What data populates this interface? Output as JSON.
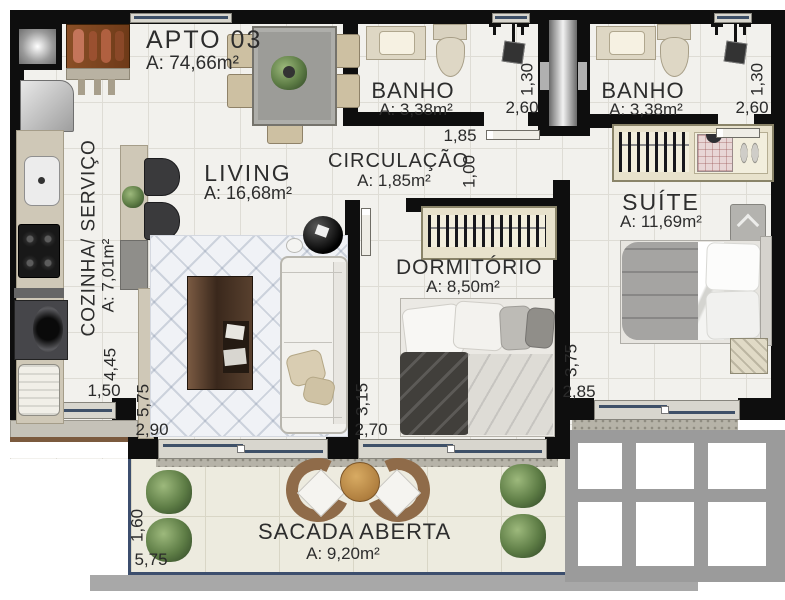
{
  "apartment": {
    "name": "APTO 03",
    "area": "A: 74,66m²"
  },
  "rooms": {
    "banho1": {
      "name": "BANHO",
      "area": "A: 3,38m²"
    },
    "banho2": {
      "name": "BANHO",
      "area": "A: 3,38m²"
    },
    "circulacao": {
      "name": "CIRCULAÇÃO",
      "area": "A: 1,85m²"
    },
    "living": {
      "name": "LIVING",
      "area": "A: 16,68m²"
    },
    "cozinha_servico": {
      "name": "COZINHA/ SERVIÇO",
      "area": "A: 7,01m²"
    },
    "dormitorio": {
      "name": "DORMITÓRIO",
      "area": "A: 8,50m²"
    },
    "suite": {
      "name": "SUÍTE",
      "area": "A: 11,69m²"
    },
    "sacada": {
      "name": "SACADA ABERTA",
      "area": "A: 9,20m²"
    }
  },
  "dimensions": {
    "banho1": {
      "width": "2,60",
      "depth": "1,30"
    },
    "banho2": {
      "width": "2,60",
      "depth": "1,30"
    },
    "circulacao": {
      "width": "1,85",
      "depth": "1,00"
    },
    "cozinha_servico": {
      "width": "1,50",
      "depth": "4,45"
    },
    "living": {
      "width": "2,90",
      "depth": "5,75"
    },
    "dormitorio": {
      "width": "2,70",
      "depth": "3,15"
    },
    "suite": {
      "width": "2,85",
      "depth": "3,75"
    },
    "sacada": {
      "width": "5,75",
      "depth": "1,60"
    }
  },
  "colors": {
    "wall": "#0e0e0e",
    "floor_tile": "#f2f1ed",
    "balcony_border": "#3c4e6d",
    "balcony_floor": "#edebdf",
    "window_glass": "#3e5068",
    "dimension_text": "#2a2a2a",
    "wood_furniture": "#4a3424",
    "greenery": "#5d7c45",
    "pergola_frame": "#9b9b9b"
  }
}
